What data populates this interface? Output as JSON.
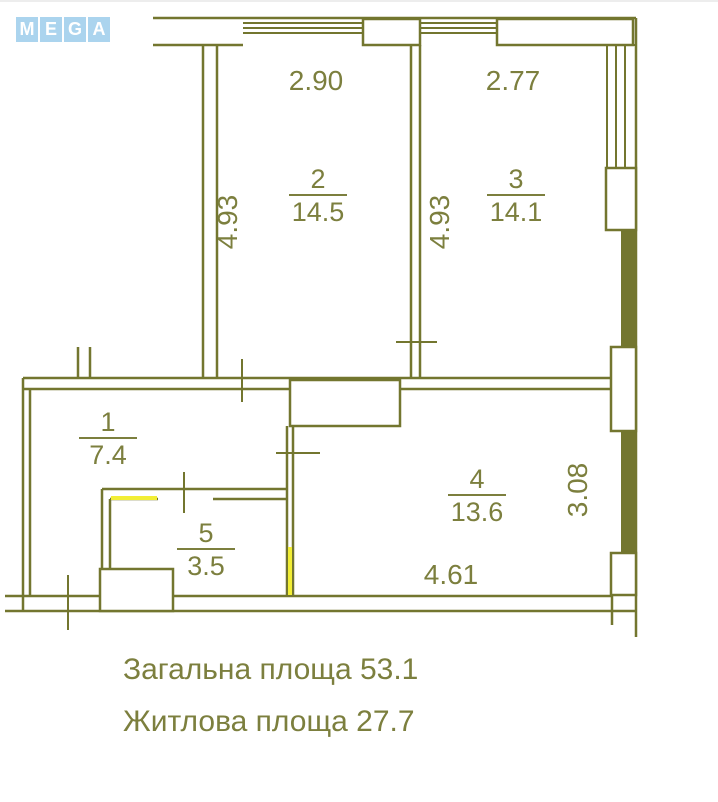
{
  "logo": {
    "letters": [
      "M",
      "E",
      "G",
      "A"
    ]
  },
  "plan": {
    "rooms": [
      {
        "number": "1",
        "area": "7.4"
      },
      {
        "number": "2",
        "area": "14.5"
      },
      {
        "number": "3",
        "area": "14.1"
      },
      {
        "number": "4",
        "area": "13.6"
      },
      {
        "number": "5",
        "area": "3.5"
      }
    ],
    "dimensions": {
      "room2_width": "2.90",
      "room3_width": "2.77",
      "room2_height": "4.93",
      "room3_height": "4.93",
      "room4_height": "3.08",
      "room4_width": "4.61"
    }
  },
  "summary": {
    "total_area": "Загальна площа 53.1",
    "living_area": "Житлова площа 27.7"
  },
  "colors": {
    "line": "#73762f",
    "text": "#7c7f3e",
    "highlight": "#f2ee35",
    "logo_blue": "#abd4ee"
  }
}
